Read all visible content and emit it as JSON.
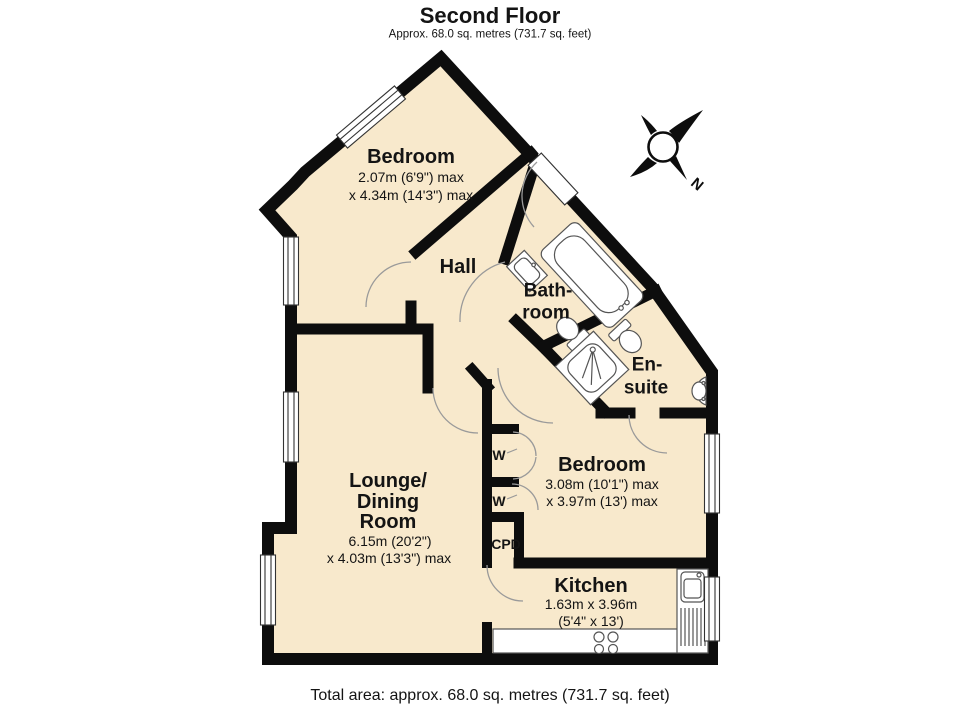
{
  "title": "Second Floor",
  "subtitle": "Approx. 68.0 sq. metres (731.7 sq. feet)",
  "footer": "Total area: approx. 68.0 sq. metres (731.7 sq. feet)",
  "compass": {
    "north_label": "N"
  },
  "colors": {
    "floor_fill": "#F8E9CC",
    "wall": "#0d0d0d",
    "door_arc": "#9a9a9a",
    "fixture_line": "#555555",
    "background": "#ffffff"
  },
  "rooms": {
    "bedroom_top": {
      "name": "Bedroom",
      "dim1": "2.07m (6'9\") max",
      "dim2": "x 4.34m (14'3\") max"
    },
    "hall": {
      "name": "Hall"
    },
    "bathroom": {
      "line1": "Bath-",
      "line2": "room"
    },
    "ensuite": {
      "line1": "En-",
      "line2": "suite"
    },
    "bedroom_right": {
      "name": "Bedroom",
      "dim1": "3.08m (10'1\") max",
      "dim2": "x 3.97m (13') max"
    },
    "lounge": {
      "line1": "Lounge/",
      "line2": "Dining",
      "line3": "Room",
      "dim1": "6.15m (20'2\")",
      "dim2": "x 4.03m (13'3\") max"
    },
    "kitchen": {
      "name": "Kitchen",
      "dim1": "1.63m x 3.96m",
      "dim2": "(5'4\" x 13')"
    },
    "wardrobe1": {
      "label": "W"
    },
    "wardrobe2": {
      "label": "W"
    },
    "cupboard": {
      "label": "CPD"
    }
  },
  "icons": {
    "compass": "compass-rose",
    "fixtures": [
      "bathtub",
      "bathroom-sink",
      "bathroom-toilet",
      "shower",
      "ensuite-toilet",
      "ensuite-sink",
      "kitchen-sink",
      "stove",
      "worktop"
    ],
    "openings": [
      "windows",
      "door-swing-arcs",
      "entrance-door"
    ]
  }
}
